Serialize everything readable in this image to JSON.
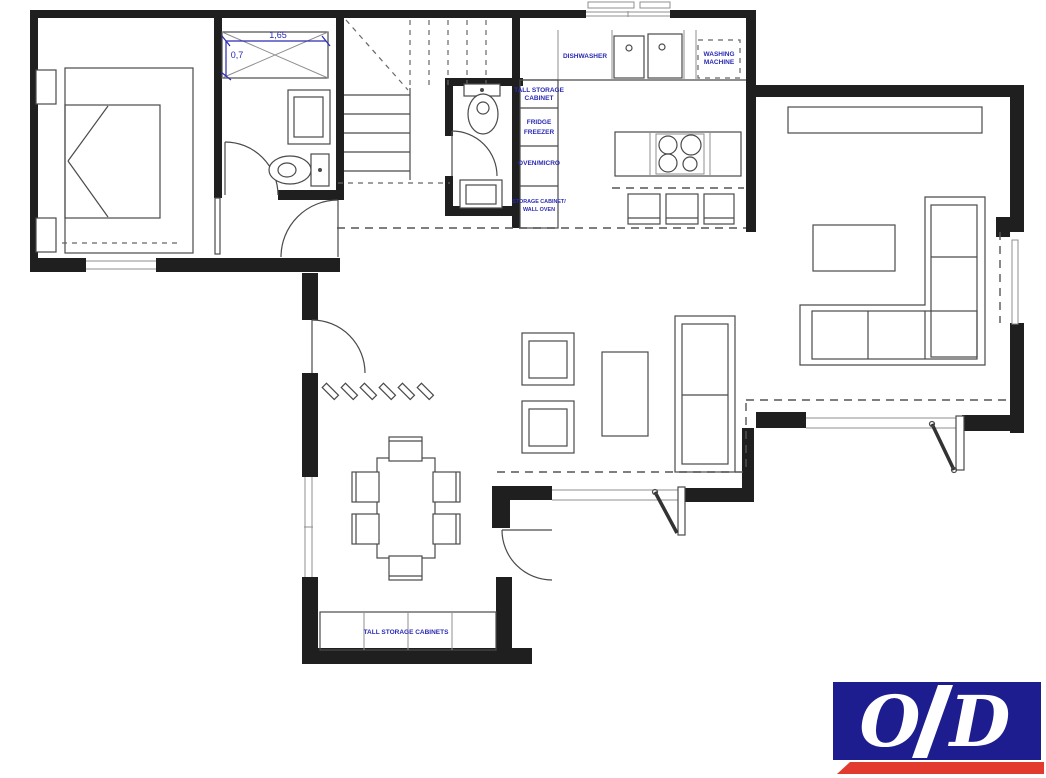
{
  "plan": {
    "annotation_color": "#2a2ab4",
    "bathroom": {
      "shower_width": "1,65",
      "shower_depth": "0,7"
    },
    "kitchen": {
      "dishwasher": "DISHWASHER",
      "washing_machine_line1": "WASHING",
      "washing_machine_line2": "MACHINE",
      "tall_storage_line1": "TALL STORAGE",
      "tall_storage_line2": "CABINET",
      "fridge_line1": "FRIDGE",
      "fridge_line2": "FREEZER",
      "oven_micro": "OVEN/MICRO",
      "storage_line1": "STORAGE CABINET/",
      "storage_line2": "WALL OVEN"
    },
    "dining": {
      "tall_storage_cabinets": "TALL STORAGE CABINETS"
    }
  },
  "logo": {
    "letter_left": "O",
    "letter_right": "D",
    "background_color": "#1d1d90",
    "underline_color": "#e23a2e",
    "letter_color": "#ffffff"
  }
}
